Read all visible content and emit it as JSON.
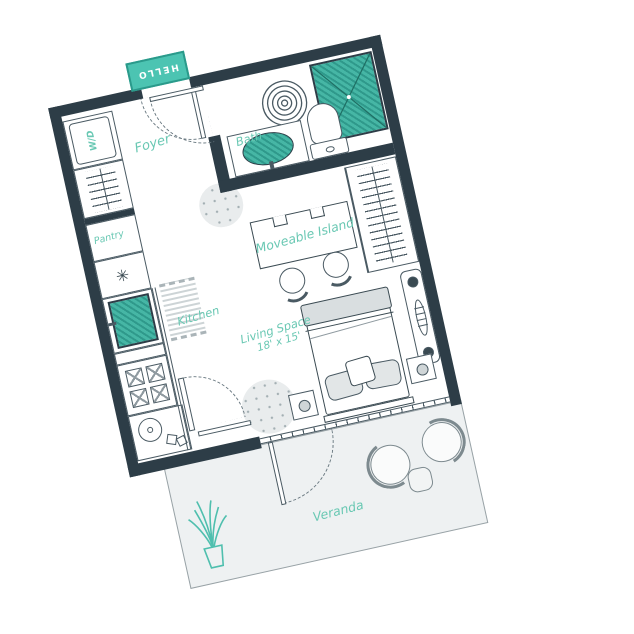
{
  "plan": {
    "type": "studio-apartment-floor-plan",
    "rotation_deg": -12.5,
    "colors": {
      "wall": "#2d3d47",
      "teal_fill": "#46b6a5",
      "teal_dark": "#2f998b",
      "label_teal": "#69c8b3",
      "outline": "#4a5a63",
      "veranda_fill": "#eef1f2",
      "soft_gray": "#e2e6e7"
    },
    "labels": {
      "entry_mat": "HELLO",
      "foyer": "Foyer",
      "bath": "Bath",
      "washer_dryer": "W/D",
      "pantry": "Pantry",
      "pantry_symbol": "✳",
      "kitchen": "Kitchen",
      "island": "Moveable Island",
      "living_space_line1": "Living Space",
      "living_space_line2": "18' x 15'",
      "veranda": "Veranda"
    },
    "rooms": [
      "Foyer",
      "Bath",
      "Pantry",
      "Kitchen",
      "Living Space",
      "Veranda"
    ],
    "living_space_dimensions": "18' x 15'",
    "furniture_visible": [
      "entry mat",
      "shower",
      "spiral rug",
      "toilet",
      "vanity sink",
      "washer-dryer",
      "coat closet",
      "fridge",
      "stove",
      "kitchen sink",
      "runner rug",
      "moveable island",
      "two stools",
      "bed with pillows",
      "two nightstands with lamps",
      "wardrobe closet",
      "console shelf",
      "two patio chairs",
      "patio table",
      "potted plant",
      "two dotted round rugs"
    ]
  }
}
